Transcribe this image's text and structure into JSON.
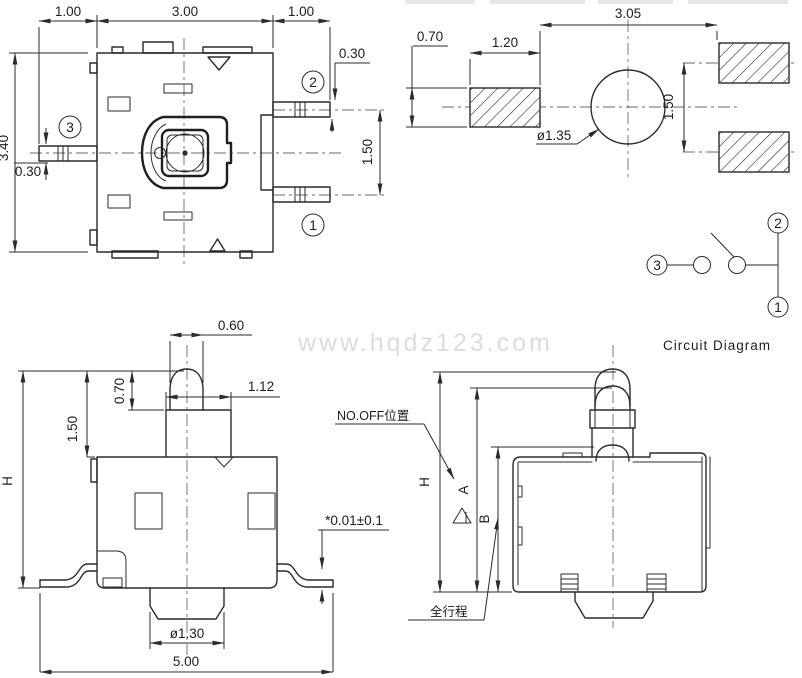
{
  "watermark": "www.hqdz123.com",
  "views": {
    "top": {
      "dims": {
        "pin_left_len": "1.00",
        "body_width": "3.00",
        "pin_right_len": "1.00",
        "pin2_width": "0.30",
        "pin_pitch": "1.50",
        "body_height": "3.40",
        "pin3_width": "0.30"
      },
      "terminals": {
        "t1": "1",
        "t2": "2",
        "t3": "3"
      }
    },
    "pcb": {
      "dims": {
        "span": "3.05",
        "pad_height": "0.70",
        "pad_width": "1.20",
        "hole_dia": "ø1.35",
        "pad_pitch": "1.50"
      }
    },
    "circuit": {
      "title": "Circuit  Diagram",
      "terminals": {
        "t1": "1",
        "t2": "2",
        "t3": "3"
      }
    },
    "front": {
      "dims": {
        "tip_width": "0.60",
        "tip_height": "0.70",
        "stem_width": "1.12",
        "plunger_height": "1.50",
        "overall_height": "H",
        "standoff": "*0.01±0.1",
        "boss_dia": "ø1.30",
        "overall_width": "5.00"
      }
    },
    "side": {
      "dims": {
        "overall_height": "H",
        "pos_a": "A",
        "pos_b": "B"
      },
      "labels": {
        "no_off": "NO.OFF位置",
        "full_travel": "全行程"
      }
    }
  }
}
